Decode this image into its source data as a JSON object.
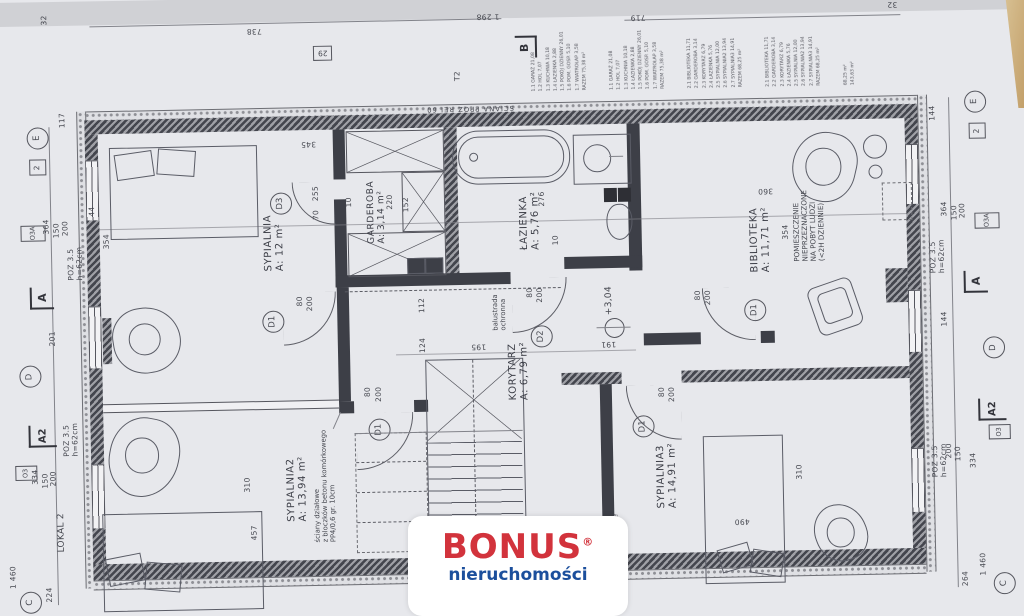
{
  "brand": {
    "name": "BONUS",
    "reg": "®",
    "subtitle": "nieruchomości",
    "red": "#d2333c",
    "blue": "#1c4f9c"
  },
  "colors": {
    "paper": "#e7e8ec",
    "ink": "#41434c",
    "wood": "#d3b586"
  },
  "rooms": {
    "sypialnia": {
      "name": "SYPIALNIA",
      "area": "A: 12 m²"
    },
    "garderoba": {
      "name": "GARDEROBA",
      "area": "A: 3,14 m²"
    },
    "lazienka": {
      "name": "ŁAZIENKA",
      "area": "A: 5,76 m²"
    },
    "biblioteka": {
      "name": "BIBLIOTEKA",
      "area": "A: 11,71 m²"
    },
    "pomieszczenie": {
      "l1": "POMIESZCZENIE",
      "l2": "NIEPRZEZNACZONE",
      "l3": "NA POBYT LUDZI",
      "l4": "(<2H DZIENNIE)"
    },
    "korytarz": {
      "name": "KORYTARZ",
      "area": "A: 6,79 m²"
    },
    "sypialnia2": {
      "name": "SYPIALNIA2",
      "area": "A: 13,94 m²"
    },
    "sypialnia3": {
      "name": "SYPIALNIA3",
      "area": "A: 14,91 m²"
    }
  },
  "annotations": {
    "sciana_ppoz": "ŚCIANA PPOŻ REI 60",
    "balustrada1": "balustrada",
    "balustrada2": "ochronna",
    "part1": "ściany działowe",
    "part2": "z bloczków betonu komórkowego",
    "part3": "PP4/0,6 gr. 10cm",
    "silikaty": "bloczki silikatowe",
    "level": "+3,04",
    "lokal2": "LOKAL 2",
    "scale": "1 460",
    "poz": "POZ 3.5",
    "pozh": "h=62cm"
  },
  "markers": {
    "E": "E",
    "D": "D",
    "C": "C",
    "B": "B",
    "two": "2",
    "t2": "T2",
    "b29": "29",
    "o3": "O3",
    "o3a": "O3A",
    "a": "A",
    "a2": "A2",
    "d1": "D1",
    "d2": "D2",
    "d3": "D3"
  },
  "dims": {
    "n10": "10",
    "n32": "32",
    "n44": "44",
    "n70": "70",
    "n80": "80",
    "n112": "112",
    "n117": "117",
    "n124": "124",
    "n144": "144",
    "n150": "150",
    "n152": "152",
    "n191": "191",
    "n195": "195",
    "n200": "200",
    "n201": "201",
    "n220": "220",
    "n224": "224",
    "n255": "255",
    "n264": "264",
    "n276": "276",
    "n310": "310",
    "n334": "334",
    "n345": "345",
    "n354": "354",
    "n360": "360",
    "n364": "364",
    "n457": "457",
    "n490": "490",
    "n719": "719",
    "n738": "738",
    "n1298": "1 298"
  },
  "legend": {
    "g1": [
      "1.1  GARAŻ  21,08",
      "1.2  HOL  7,07",
      "1.3  KUCHNIA  10,18",
      "1.4  ŁAZIENKA  2,88",
      "1.5  POKÓJ DZIENNY  26,01",
      "1.6  POM. GOSP.  5,10",
      "1.7  WIATROŁAP  3,58",
      "RAZEM  75,38 m²"
    ],
    "g2": [
      "1.1  GARAŻ  21,08",
      "1.2  HOL  7,07",
      "1.3  KUCHNIA  10,18",
      "1.4  ŁAZIENKA  2,88",
      "1.5  POKÓJ DZIENNY  26,01",
      "1.6  POM. GOSP.  5,10",
      "1.7  WIATROŁAP  3,58",
      "RAZEM  75,38 m²"
    ],
    "g3": [
      "2.1  BIBLIOTEKA  11,71",
      "2.2  GARDEROBA  3,14",
      "2.3  KORYTARZ  6,79",
      "2.4  ŁAZIENKA  5,76",
      "2.5  SYPIALNIA  12,00",
      "2.6  SYPIALNIA2  13,94",
      "2.7  SYPIALNIA3  14,91",
      "RAZEM  68,25 m²"
    ],
    "g4": [
      "2.1  BIBLIOTEKA  11,71",
      "2.2  GARDEROBA  3,14",
      "2.3  KORYTARZ  6,79",
      "2.4  ŁAZIENKA  5,76",
      "2.5  SYPIALNIA  12,00",
      "2.6  SYPIALNIA2  13,94",
      "2.7  SYPIALNIA3  14,91",
      "RAZEM  68,25 m²"
    ],
    "tot1": "68,25 m²",
    "tot2": "143,63 m²"
  }
}
